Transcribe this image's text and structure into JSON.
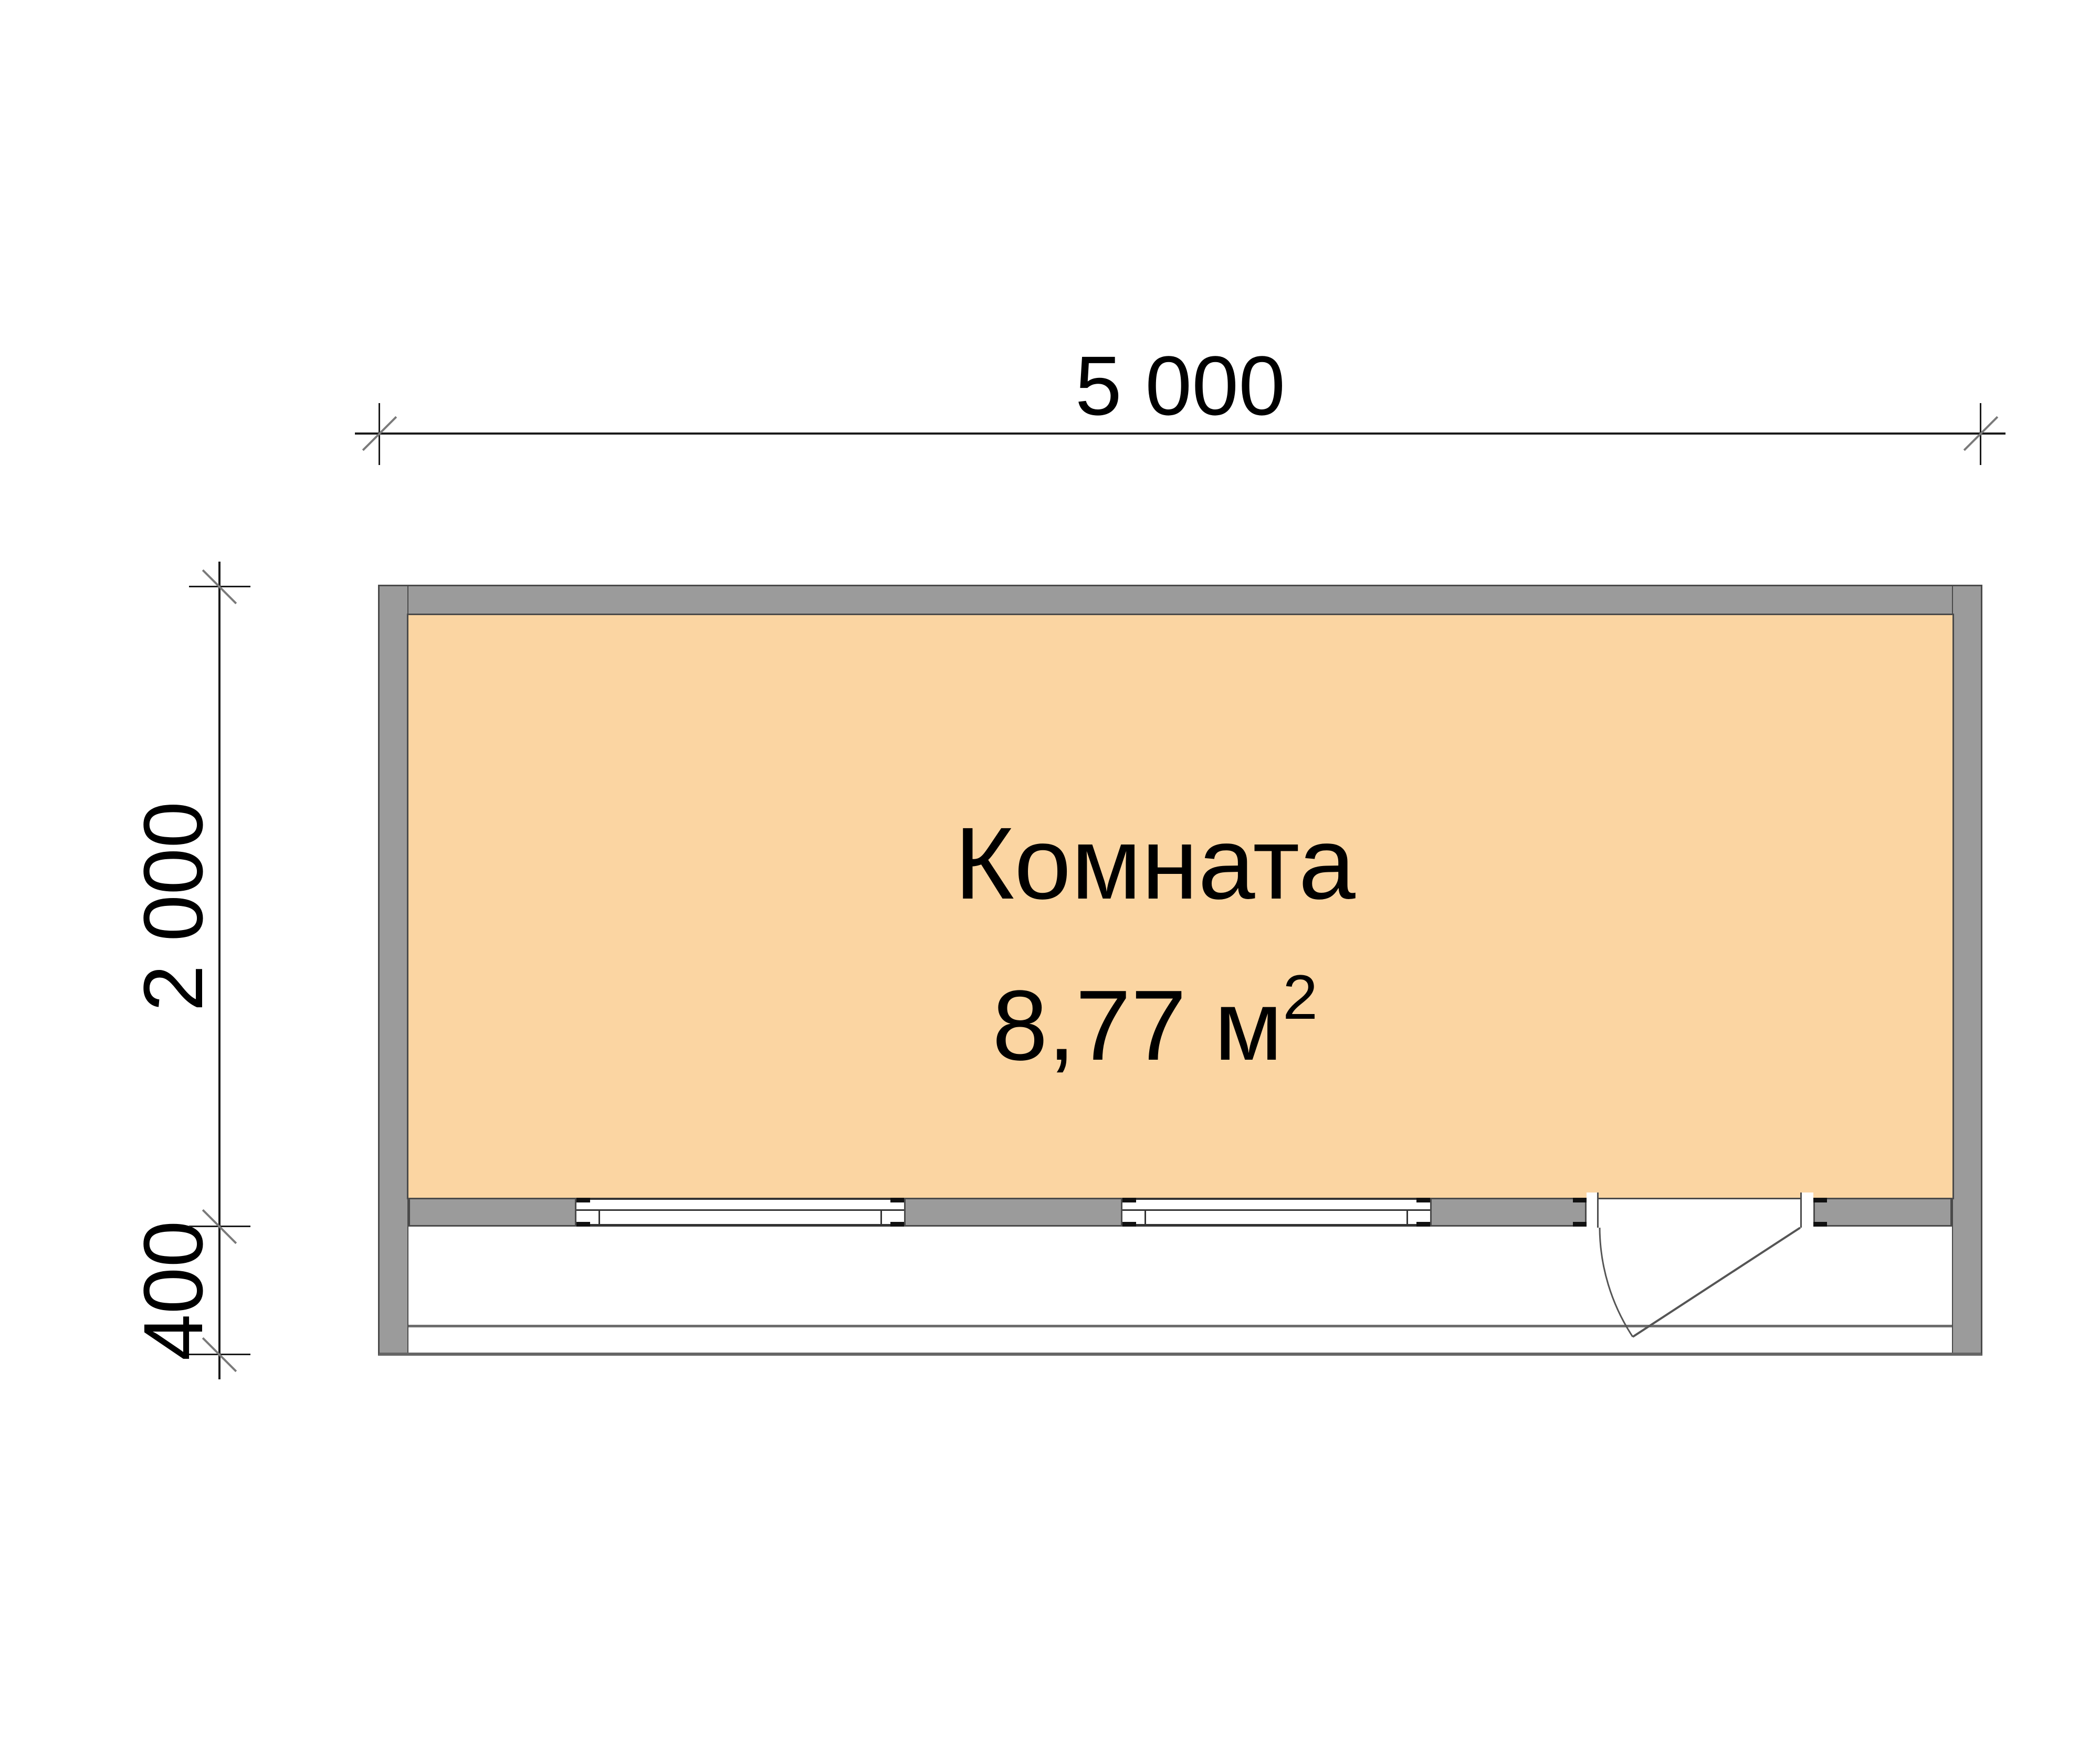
{
  "plan_type": "floor-plan",
  "room": {
    "name": "Комната",
    "area_value": "8,77 м",
    "area_sup": "2"
  },
  "dimensions": {
    "width": {
      "label": "5 000"
    },
    "depth": {
      "label": "2 000"
    },
    "veranda_depth": {
      "label": "400"
    }
  },
  "features": {
    "windows": 2,
    "door": "swing door opening onto veranda",
    "veranda": "open porch along bottom side"
  },
  "colors": {
    "wall_fill": "#9b9b9b",
    "wall_outline": "#4a4a4a",
    "room_fill": "#fbd5a2",
    "dimension_line": "#1a1a1a",
    "tick_slash": "#7a7a7a",
    "bottom_edge": "#666666",
    "veranda_rail": "#6e6e6e",
    "window_frame": "#333333"
  }
}
